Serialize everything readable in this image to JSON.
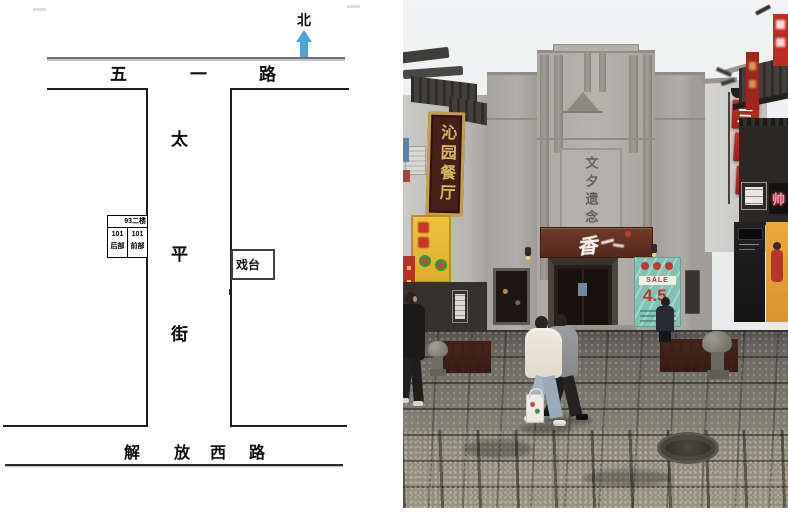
{
  "map": {
    "compass": {
      "label": "北",
      "arrow_color": "#4BA3DC"
    },
    "top_road": {
      "name": "五一路",
      "chars": [
        "五",
        "一",
        "路"
      ]
    },
    "street": {
      "name": "太平街",
      "chars": [
        "太",
        "平",
        "街"
      ]
    },
    "bottom_road": {
      "name": "解放西路",
      "chars": [
        "解",
        "放",
        "西",
        "路"
      ]
    },
    "stage_box": {
      "label": "戏台"
    },
    "unit_boxes": {
      "upper": {
        "label": "93二楼"
      },
      "rear": {
        "line1": "101",
        "line2": "后部"
      },
      "front": {
        "line1": "101",
        "line2": "前部"
      }
    }
  },
  "photo": {
    "facade_inscription": "文夕遗念",
    "entrance_sign_text": "香",
    "restaurant_sign": "沁园餐厅",
    "hall_sign": {
      "name": "三缘堂",
      "chars": [
        "三",
        "缘",
        "堂"
      ]
    },
    "poster": {
      "sale_label": "SALE",
      "rate_text": "4.5"
    },
    "glow_sign_text": "帅",
    "colors": {
      "sign_maroon": "#5E2C1D",
      "sign_red": "#B5261D",
      "poster_teal": "#7FC3B3",
      "snack_sign_yellow": "#E6BD35",
      "gold_text": "#D9B65E",
      "facade_gray": "#ACAAA3"
    }
  }
}
